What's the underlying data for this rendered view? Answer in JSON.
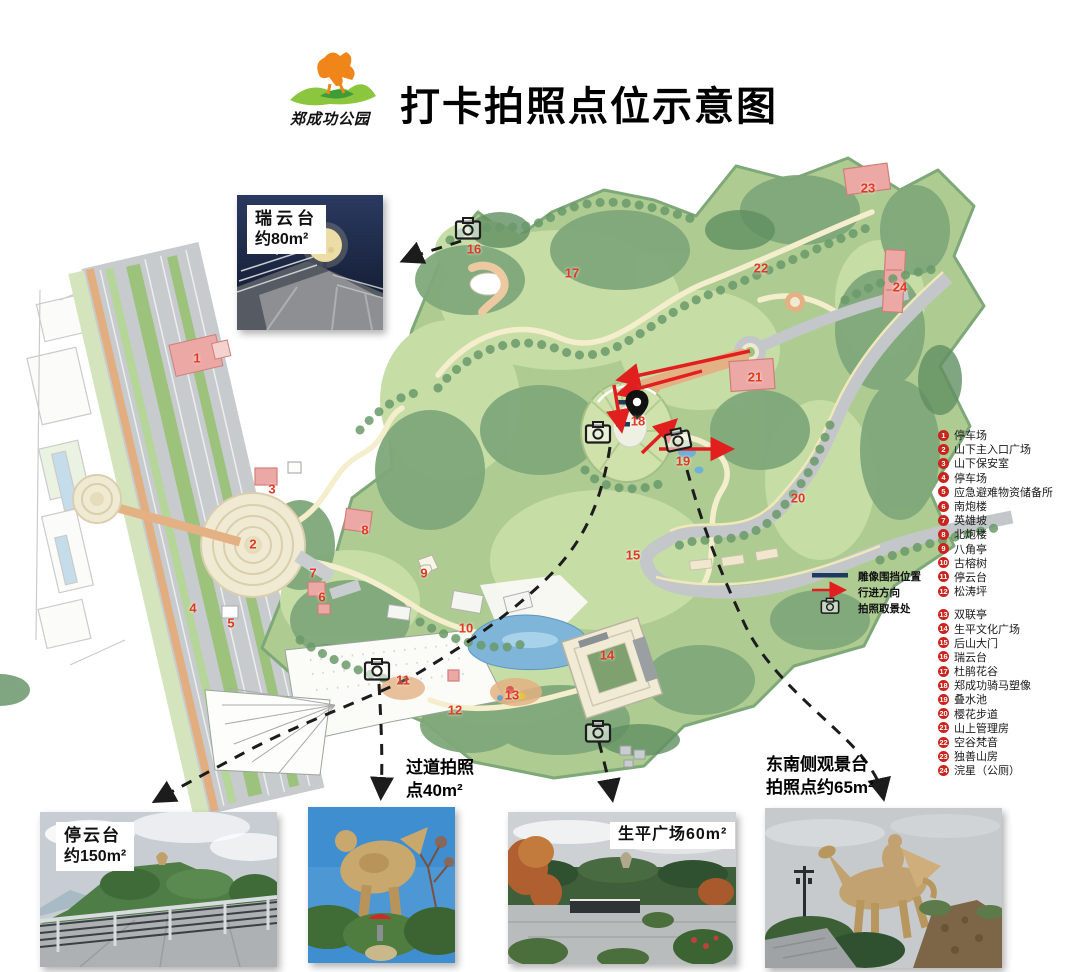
{
  "header": {
    "title": "打卡拍照点位示意图",
    "logo_text": "郑成功公园"
  },
  "colors": {
    "marker_red": "#e0391f",
    "legend_red": "#c8251f",
    "arrow_red": "#e21f1f",
    "fence_navy": "#1f3a5f"
  },
  "map": {
    "markers": [
      {
        "n": "1",
        "x": 197,
        "y": 358
      },
      {
        "n": "2",
        "x": 253,
        "y": 544
      },
      {
        "n": "3",
        "x": 272,
        "y": 489
      },
      {
        "n": "4",
        "x": 193,
        "y": 608
      },
      {
        "n": "5",
        "x": 231,
        "y": 623
      },
      {
        "n": "6",
        "x": 322,
        "y": 597
      },
      {
        "n": "7",
        "x": 313,
        "y": 573
      },
      {
        "n": "8",
        "x": 365,
        "y": 530
      },
      {
        "n": "9",
        "x": 424,
        "y": 573
      },
      {
        "n": "10",
        "x": 466,
        "y": 628
      },
      {
        "n": "11",
        "x": 403,
        "y": 680
      },
      {
        "n": "12",
        "x": 455,
        "y": 710
      },
      {
        "n": "13",
        "x": 512,
        "y": 695
      },
      {
        "n": "14",
        "x": 607,
        "y": 655
      },
      {
        "n": "15",
        "x": 633,
        "y": 555
      },
      {
        "n": "16",
        "x": 474,
        "y": 249
      },
      {
        "n": "17",
        "x": 572,
        "y": 273
      },
      {
        "n": "18",
        "x": 638,
        "y": 421
      },
      {
        "n": "19",
        "x": 683,
        "y": 461
      },
      {
        "n": "20",
        "x": 798,
        "y": 498
      },
      {
        "n": "21",
        "x": 755,
        "y": 377
      },
      {
        "n": "22",
        "x": 761,
        "y": 268
      },
      {
        "n": "23",
        "x": 868,
        "y": 188
      },
      {
        "n": "24",
        "x": 900,
        "y": 287
      }
    ],
    "mini_legend": {
      "items": [
        {
          "label": "雕像围挡位置"
        },
        {
          "label": "行进方向"
        },
        {
          "label": "拍照取景处"
        }
      ]
    }
  },
  "legend": {
    "items": [
      {
        "n": "1",
        "label": "停车场"
      },
      {
        "n": "2",
        "label": "山下主入口广场"
      },
      {
        "n": "3",
        "label": "山下保安室"
      },
      {
        "n": "4",
        "label": "停车场"
      },
      {
        "n": "5",
        "label": "应急避难物资储备所"
      },
      {
        "n": "6",
        "label": "南炮楼"
      },
      {
        "n": "7",
        "label": "英雄坡"
      },
      {
        "n": "8",
        "label": "北炮楼"
      },
      {
        "n": "9",
        "label": "八角亭"
      },
      {
        "n": "10",
        "label": "古榕树"
      },
      {
        "n": "11",
        "label": "停云台"
      },
      {
        "n": "12",
        "label": "松涛坪"
      },
      {
        "n": "13",
        "label": "双联亭"
      },
      {
        "n": "14",
        "label": "生平文化广场"
      },
      {
        "n": "15",
        "label": "后山大门"
      },
      {
        "n": "16",
        "label": "瑞云台"
      },
      {
        "n": "17",
        "label": "杜鹃花谷"
      },
      {
        "n": "18",
        "label": "郑成功骑马塑像"
      },
      {
        "n": "19",
        "label": "叠水池"
      },
      {
        "n": "20",
        "label": "樱花步道"
      },
      {
        "n": "21",
        "label": "山上管理房"
      },
      {
        "n": "22",
        "label": "空谷梵音"
      },
      {
        "n": "23",
        "label": "独善山房"
      },
      {
        "n": "24",
        "label": "浣星（公厕）"
      }
    ]
  },
  "callouts": {
    "ruiyun": {
      "name": "瑞云台",
      "area": "约80m²"
    },
    "tingyun": {
      "name": "停云台",
      "area": "约150m²"
    },
    "guodao": {
      "line1": "过道拍照",
      "line2": "点40m²"
    },
    "shengping": {
      "label": "生平广场60m²"
    },
    "dongnan": {
      "line1": "东南侧观景台",
      "line2": "拍照点约65m²"
    }
  }
}
